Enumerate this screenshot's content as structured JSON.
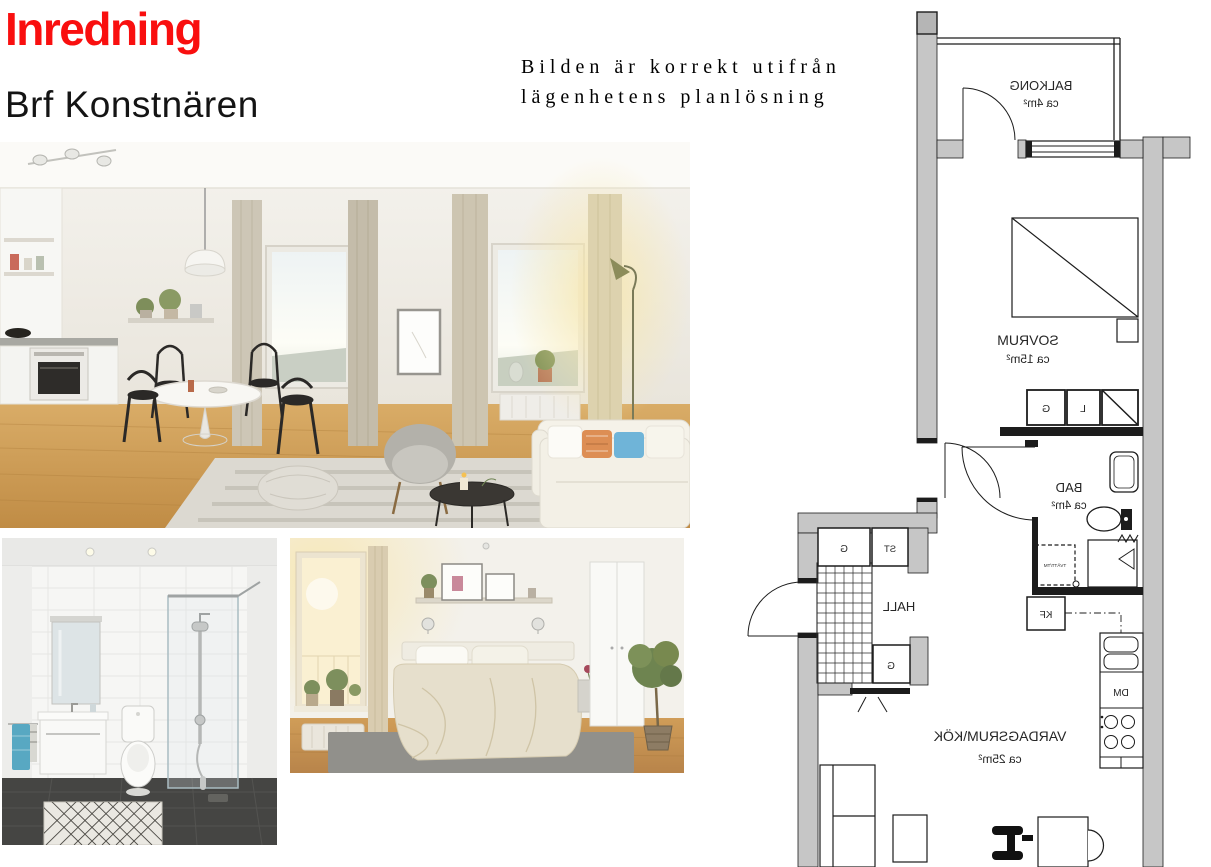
{
  "header": {
    "title": "Inredning",
    "subtitle": "Brf Konstnären",
    "title_color": "#f90f0f"
  },
  "note": {
    "line1": "Bilden är korrekt utifrån",
    "line2": "lägenhetens planlösning"
  },
  "floorplan": {
    "orientation": "mirrored",
    "wall_color": "#c6c6c6",
    "line_color": "#1c1c1c",
    "rooms": {
      "balkong": {
        "name": "BALKONG",
        "area": "ca 4m²"
      },
      "sovrum": {
        "name": "SOVRUM",
        "area": "ca 15m²"
      },
      "bad": {
        "name": "BAD",
        "area": "ca 4m²"
      },
      "hall": {
        "name": "HALL"
      },
      "vardagsrum": {
        "name": "VARDAGSRUM\\KÖK",
        "area": "ca 25m²"
      }
    },
    "fixtures": {
      "g": "G",
      "st": "ST",
      "l": "L",
      "kf": "KF",
      "dm": "DM",
      "laundry": "TVÄTT/TM"
    }
  }
}
